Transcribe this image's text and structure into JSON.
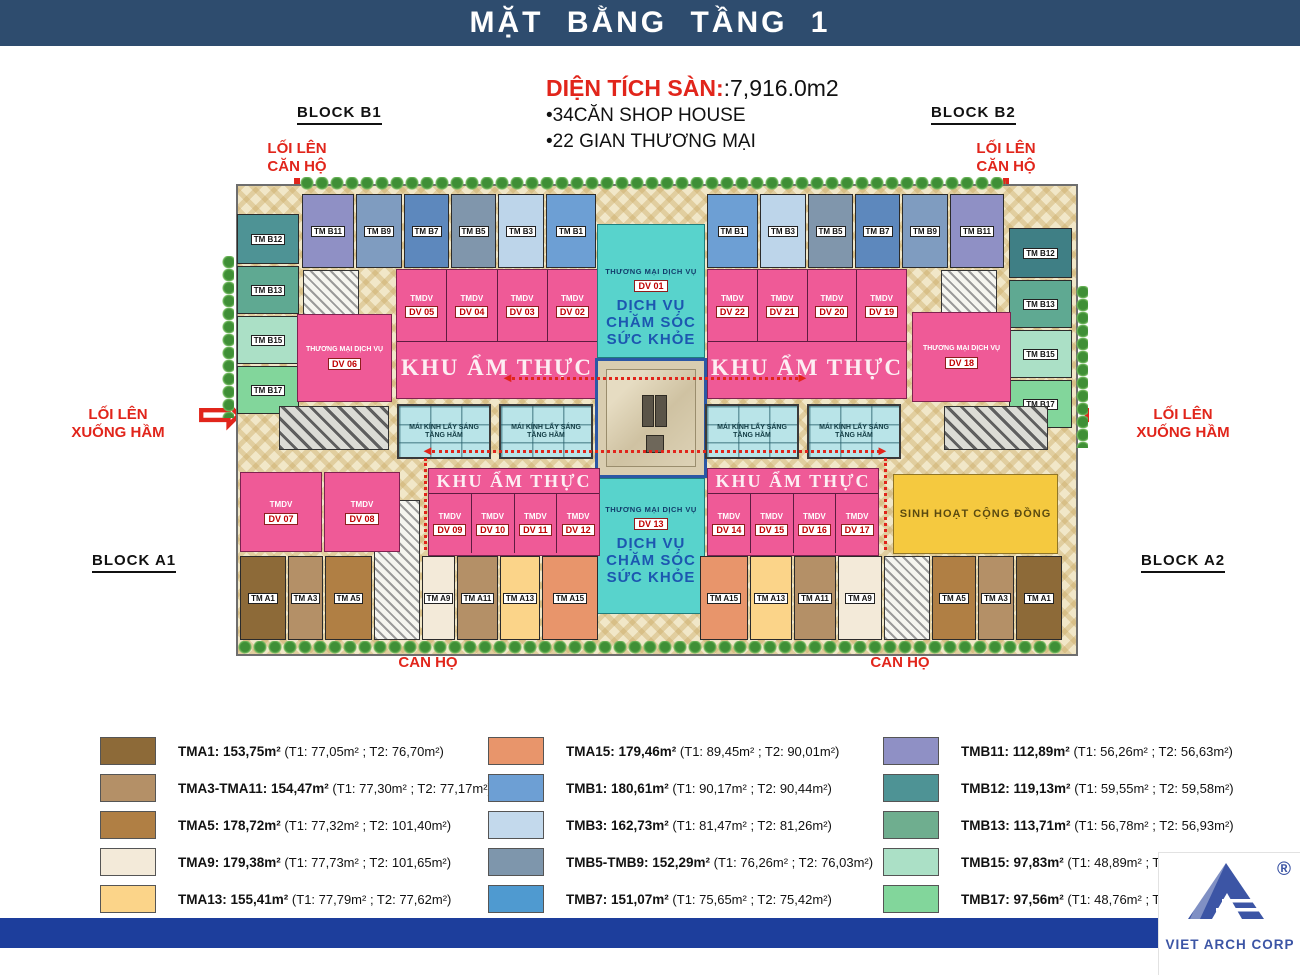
{
  "title": "MẶT BẰNG TẦNG 1",
  "info": {
    "area_label": "DIỆN TÍCH SÀN:",
    "area_value": ":7,916.0m2",
    "bullet1": "•34CĂN SHOP HOUSE",
    "bullet2": "•22 GIAN THƯƠNG MẠI"
  },
  "blocks": {
    "b1": "BLOCK B1",
    "b2": "BLOCK B2",
    "a1": "BLOCK A1",
    "a2": "BLOCK A2"
  },
  "access": {
    "up_l1": "LỐI LÊN",
    "up_l2": "CĂN HỘ",
    "ham_l1": "LỐI LÊN",
    "ham_l2": "XUỐNG HẦM",
    "down_arrow": "⬇",
    "up_arrow": "⬆",
    "right_arrow": "⇨",
    "left_arrow": "⇦"
  },
  "plan": {
    "tm_dv_title": "THƯƠNG MẠI DỊCH VỤ",
    "tmdv_label": "TMDV",
    "food_court_label": "KHU ẨM THỰC",
    "skylight_label": "MÁI KÍNH LẤY SÁNG TẦNG HẦM",
    "community_label": "SINH HOẠT CỘNG ĐỒNG",
    "health": {
      "l1": "DỊCH VỤ",
      "l2": "CHĂM SÓC",
      "l3": "SỨC KHỎE"
    },
    "center_top_dv": "DV 01",
    "center_bottom_dv": "DV 13",
    "dv_side_left": "DV 06",
    "dv_side_right": "DV 18",
    "dv_07": "DV 07",
    "dv_08": "DV 08",
    "b_left_col": [
      "TM B12",
      "TM B13",
      "TM B15",
      "TM B17"
    ],
    "b_right_col": [
      "TM B12",
      "TM B13",
      "TM B15",
      "TM B17"
    ],
    "b_top_left": [
      "TM B11",
      "TM B9",
      "TM B7",
      "TM B5",
      "TM B3",
      "TM B1"
    ],
    "b_top_right": [
      "TM B1",
      "TM B3",
      "TM B5",
      "TM B7",
      "TM B9",
      "TM B11"
    ],
    "dv_upper_left": [
      "DV 05",
      "DV 04",
      "DV 03",
      "DV 02"
    ],
    "dv_upper_right": [
      "DV 22",
      "DV 21",
      "DV 20",
      "DV 19"
    ],
    "dv_lower_left": [
      "DV 09",
      "DV 10",
      "DV 11",
      "DV 12"
    ],
    "dv_lower_right": [
      "DV 14",
      "DV 15",
      "DV 16",
      "DV 17"
    ],
    "a_bottom_left": [
      "TM A1",
      "TM A3",
      "TM A5",
      "TM A9",
      "TM A11",
      "TM A13",
      "TM A15"
    ],
    "a_bottom_right": [
      "TM A15",
      "TM A13",
      "TM A11",
      "TM A9",
      "TM A5",
      "TM A3",
      "TM A1"
    ]
  },
  "legend": {
    "col1": [
      {
        "name": "TMA1: 153,75m²",
        "detail": "(T1: 77,05m² ; T2: 76,70m²)",
        "color": "#8d6a38"
      },
      {
        "name": "TMA3-TMA11: 154,47m²",
        "detail": "(T1: 77,30m² ; T2: 77,17m²)",
        "color": "#b49067"
      },
      {
        "name": "TMA5: 178,72m²",
        "detail": "(T1: 77,32m² ; T2: 101,40m²)",
        "color": "#b07f44"
      },
      {
        "name": "TMA9: 179,38m²",
        "detail": "(T1: 77,73m² ; T2: 101,65m²)",
        "color": "#f3ead9"
      },
      {
        "name": "TMA13: 155,41m²",
        "detail": "(T1: 77,79m² ; T2: 77,62m²)",
        "color": "#fbd489"
      }
    ],
    "col2": [
      {
        "name": "TMA15: 179,46m²",
        "detail": "(T1: 89,45m² ; T2: 90,01m²)",
        "color": "#e8956b"
      },
      {
        "name": "TMB1: 180,61m²",
        "detail": "(T1: 90,17m² ; T2: 90,44m²)",
        "color": "#6d9fd4"
      },
      {
        "name": "TMB3: 162,73m²",
        "detail": "(T1: 81,47m² ; T2: 81,26m²)",
        "color": "#c3d9ec"
      },
      {
        "name": "TMB5-TMB9: 152,29m²",
        "detail": "(T1: 76,26m² ; T2: 76,03m²)",
        "color": "#7e96ac"
      },
      {
        "name": "TMB7: 151,07m²",
        "detail": "(T1: 75,65m² ; T2: 75,42m²)",
        "color": "#4f9ad0"
      }
    ],
    "col3": [
      {
        "name": "TMB11: 112,89m²",
        "detail": "(T1: 56,26m² ; T2: 56,63m²)",
        "color": "#8f90c5"
      },
      {
        "name": "TMB12: 119,13m²",
        "detail": "(T1: 59,55m² ; T2: 59,58m²)",
        "color": "#4e9395"
      },
      {
        "name": "TMB13: 113,71m²",
        "detail": "(T1: 56,78m² ; T2: 56,93m²)",
        "color": "#6fae8f"
      },
      {
        "name": "TMB15: 97,83m²",
        "detail": "(T1: 48,89m² ; T2: 48,94m²)",
        "color": "#abe0c6"
      },
      {
        "name": "TMB17: 97,56m²",
        "detail": "(T1: 48,76m² ; T2: 48",
        "color": "#82d69b"
      }
    ]
  },
  "logo": {
    "name": "VIET ARCH CORP",
    "reg": "®"
  }
}
